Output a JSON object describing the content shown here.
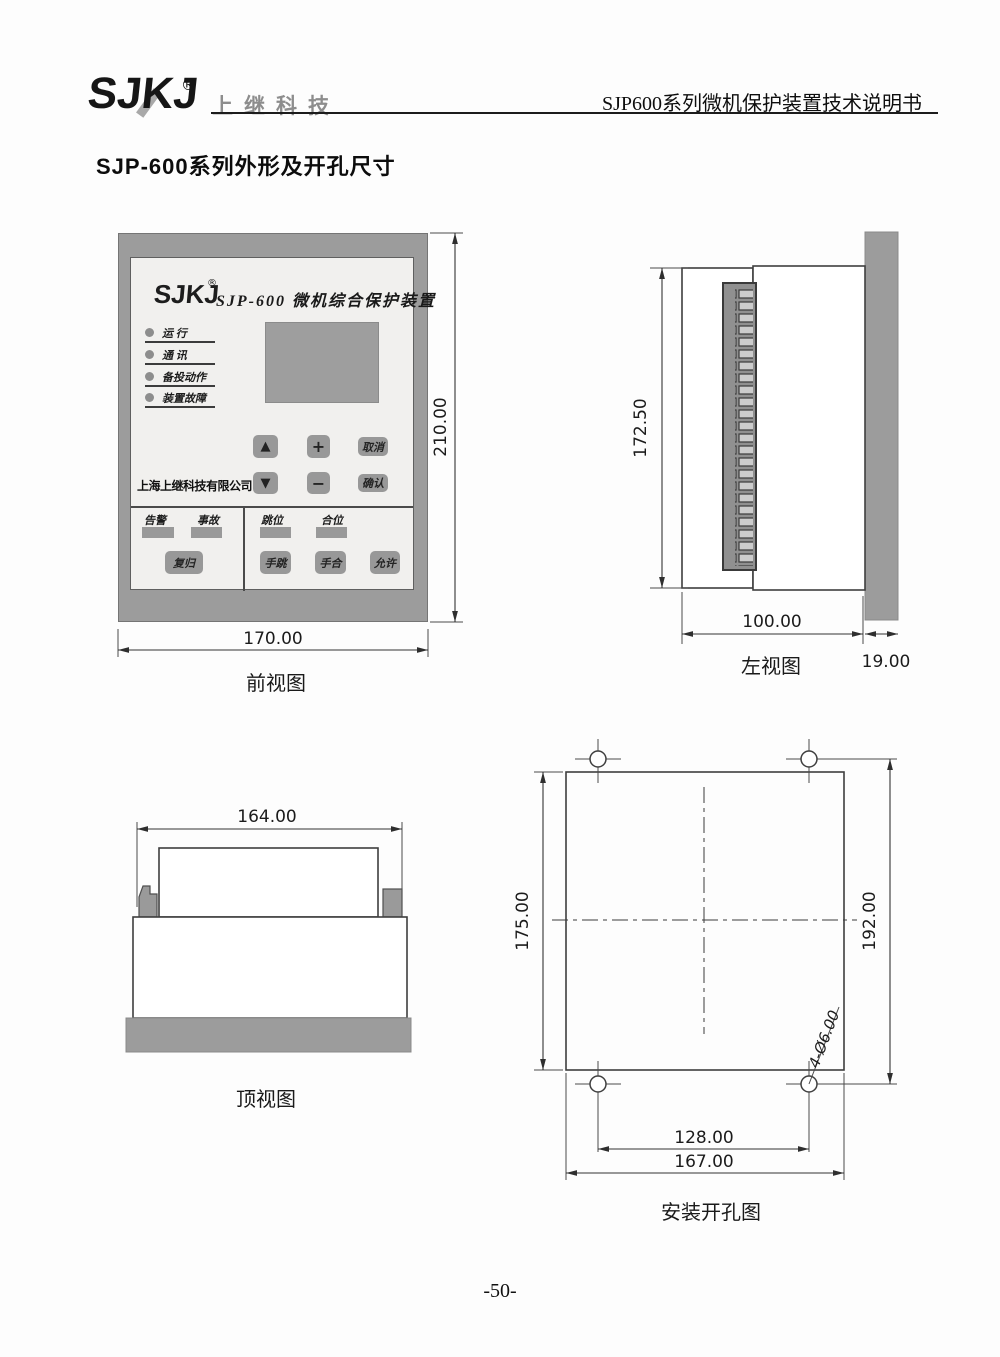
{
  "header": {
    "logo": "SJKJ",
    "registered": "®",
    "brand": "上继科技",
    "doc_title": "SJP600系列微机保护装置技术说明书"
  },
  "page_title": "SJP-600系列外形及开孔尺寸",
  "front_view": {
    "caption": "前视图",
    "dims": {
      "width": "170.00",
      "height": "210.00"
    },
    "panel": {
      "logo": "SJKJ",
      "registered": "®",
      "title": "SJP-600 微机综合保护装置",
      "leds": [
        "运 行",
        "通 讯",
        "备投动作",
        "装置故障"
      ],
      "keys": {
        "up": "▲",
        "plus": "+",
        "cancel": "取消",
        "down": "▼",
        "minus": "−",
        "confirm": "确认"
      },
      "company": "上海上继科技有限公司",
      "signal_left": {
        "labels": [
          "告警",
          "事故"
        ],
        "button": "复归"
      },
      "signal_right": {
        "labels": [
          "跳位",
          "合位"
        ],
        "buttons": [
          "手跳",
          "手合",
          "允许"
        ]
      }
    }
  },
  "left_view": {
    "caption": "左视图",
    "dims": {
      "height": "172.50",
      "depth": "100.00",
      "flange": "19.00"
    }
  },
  "top_view": {
    "caption": "顶视图",
    "dims": {
      "width": "164.00"
    }
  },
  "cutout_view": {
    "caption": "安装开孔图",
    "dims": {
      "cutout_height": "175.00",
      "hole_height": "192.00",
      "hole_span": "128.00",
      "cutout_width": "167.00",
      "hole_note": "4-Ø6.00"
    }
  },
  "footer": {
    "page_number": "-50-"
  }
}
